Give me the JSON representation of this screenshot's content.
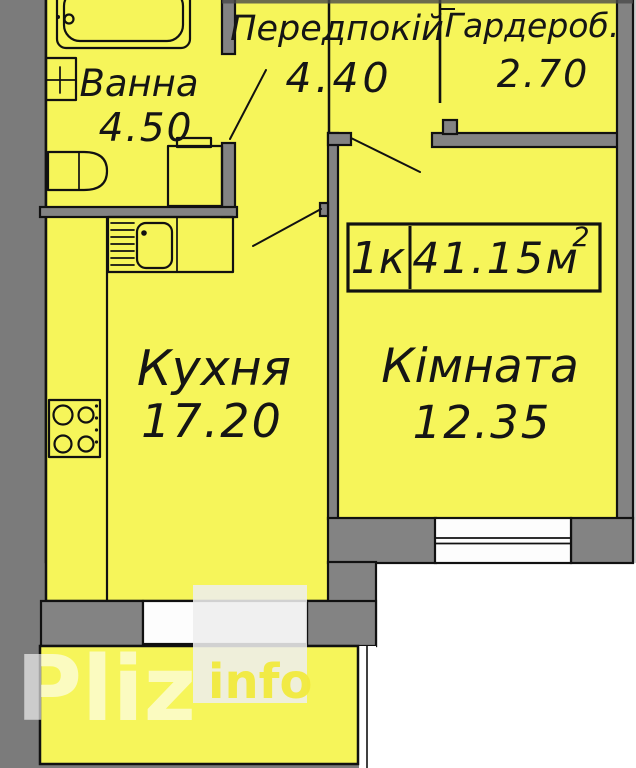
{
  "plan": {
    "title": "apartment-floor-plan",
    "rooms": [
      {
        "key": "hallway",
        "label": "Передпокій",
        "area": "4.40"
      },
      {
        "key": "wardrobe",
        "label": "Гардероб.",
        "area": "2.70"
      },
      {
        "key": "bathroom",
        "label": "Ванна",
        "area": "4.50"
      },
      {
        "key": "kitchen",
        "label": "Кухня",
        "area": "17.20"
      },
      {
        "key": "room",
        "label": "Кімната",
        "area": "12.35"
      }
    ],
    "badge": {
      "rooms_count": "1к",
      "area_value": "41.15м",
      "area_superscript": "2"
    },
    "watermark": {
      "primary": "Pliz",
      "secondary": "info"
    },
    "fixtures": [
      "bathtub-icon",
      "washbasin-icon",
      "toilet-icon",
      "washing-machine-icon",
      "kitchen-sink-icon",
      "drainer-icon",
      "stove-icon",
      "window",
      "balcony",
      "door-swing"
    ],
    "colors": {
      "interior_yellow": "#f6f55a",
      "wall_gray": "#838383",
      "background_gray": "#7b7b7b",
      "outline_black": "#111111",
      "outside_white": "#ffffff",
      "watermark_box": "#eeeeee",
      "watermark_text_yellow": "#f2ea3e"
    }
  }
}
